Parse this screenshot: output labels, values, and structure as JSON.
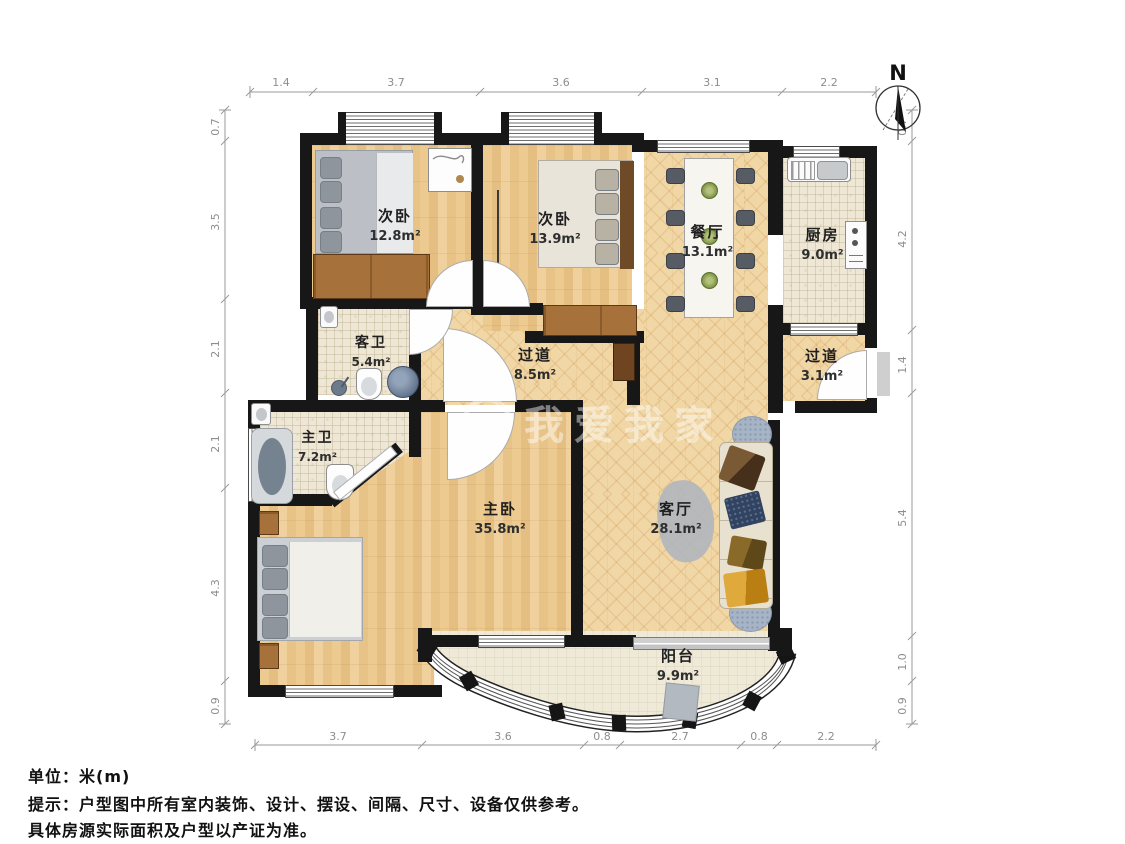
{
  "meta": {
    "unit_label": "单位：米(m)",
    "tip_line1": "提示：户型图中所有室内装饰、设计、摆设、间隔、尺寸、设备仅供参考。",
    "tip_line2": "具体房源实际面积及户型以产证为准。",
    "compass_label": "N",
    "watermark": "我爱我家"
  },
  "rooms": [
    {
      "id": "bed1",
      "name": "次卧",
      "area": "12.8m²"
    },
    {
      "id": "bed2",
      "name": "次卧",
      "area": "13.9m²"
    },
    {
      "id": "dining",
      "name": "餐厅",
      "area": "13.1m²"
    },
    {
      "id": "kitchen",
      "name": "厨房",
      "area": "9.0m²"
    },
    {
      "id": "hall1",
      "name": "过道",
      "area": "8.5m²"
    },
    {
      "id": "hall2",
      "name": "过道",
      "area": "3.1m²"
    },
    {
      "id": "bath_guest",
      "name": "客卫",
      "area": "5.4m²"
    },
    {
      "id": "bath_master",
      "name": "主卫",
      "area": "7.2m²"
    },
    {
      "id": "master",
      "name": "主卧",
      "area": "35.8m²"
    },
    {
      "id": "living",
      "name": "客厅",
      "area": "28.1m²"
    },
    {
      "id": "balcony",
      "name": "阳台",
      "area": "9.9m²"
    }
  ],
  "dimensions": {
    "top": [
      "1.4",
      "3.7",
      "3.6",
      "3.1",
      "2.2"
    ],
    "bottom": [
      "3.7",
      "3.6",
      "0.8",
      "2.7",
      "0.8",
      "2.2"
    ],
    "left": [
      "0.7",
      "3.5",
      "2.1",
      "2.1",
      "4.3",
      "0.9"
    ],
    "right": [
      "0.7",
      "4.2",
      "1.4",
      "5.4",
      "1.0",
      "0.9"
    ]
  },
  "colors": {
    "wall": "#171717",
    "wood_floor": "#ecca90",
    "herringbone_floor": "#f2d7a6",
    "tile_floor": "#eee7d5",
    "dim_text": "#8d8d8d"
  }
}
